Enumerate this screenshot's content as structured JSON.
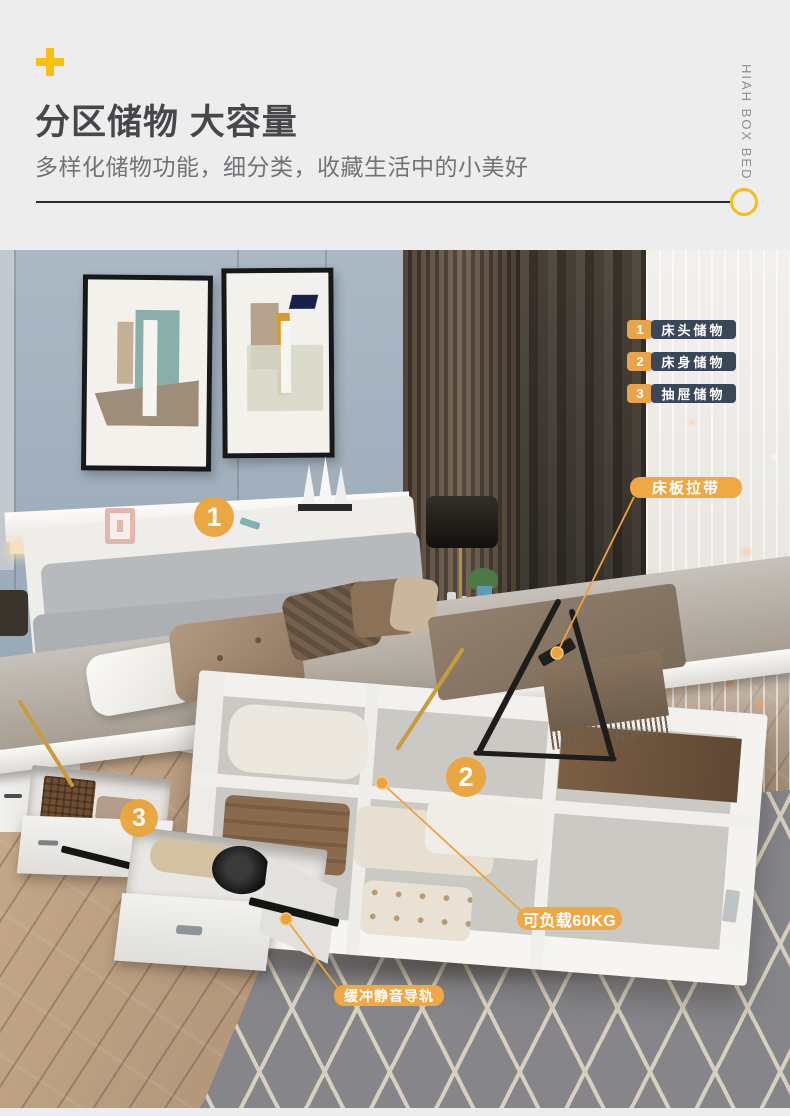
{
  "page": {
    "background": "#EDEDEE"
  },
  "header": {
    "title": "分区储物 大容量",
    "subtitle": "多样化储物功能，细分类，收藏生活中的小美好",
    "brand_vertical_text": "HIAH BOX BED",
    "accent_color": "#F6BE13",
    "title_color": "#46464B",
    "subtitle_color": "#737377"
  },
  "legend": {
    "num_bg": "#E8A44A",
    "label_bg": "#3A4659",
    "items": [
      {
        "num": "1",
        "label": "床头储物"
      },
      {
        "num": "2",
        "label": "床身储物"
      },
      {
        "num": "3",
        "label": "抽屉储物"
      }
    ]
  },
  "callouts": {
    "label_bg": "#EFA845",
    "line_color": "#EDA23C",
    "bed_board_strap": {
      "text": "床板拉带"
    },
    "load_capacity": {
      "text": "可负载60KG"
    },
    "silent_rail": {
      "text": "缓冲静音导轨"
    }
  },
  "badges": {
    "bg": "#E9A63F",
    "items": [
      {
        "num": "1"
      },
      {
        "num": "2"
      },
      {
        "num": "3"
      }
    ]
  },
  "scene": {
    "description": "bedroom with white hydraulic lift storage bed, mattress raised to show divided compartments, two open side drawers, gray wave-pattern rug"
  }
}
